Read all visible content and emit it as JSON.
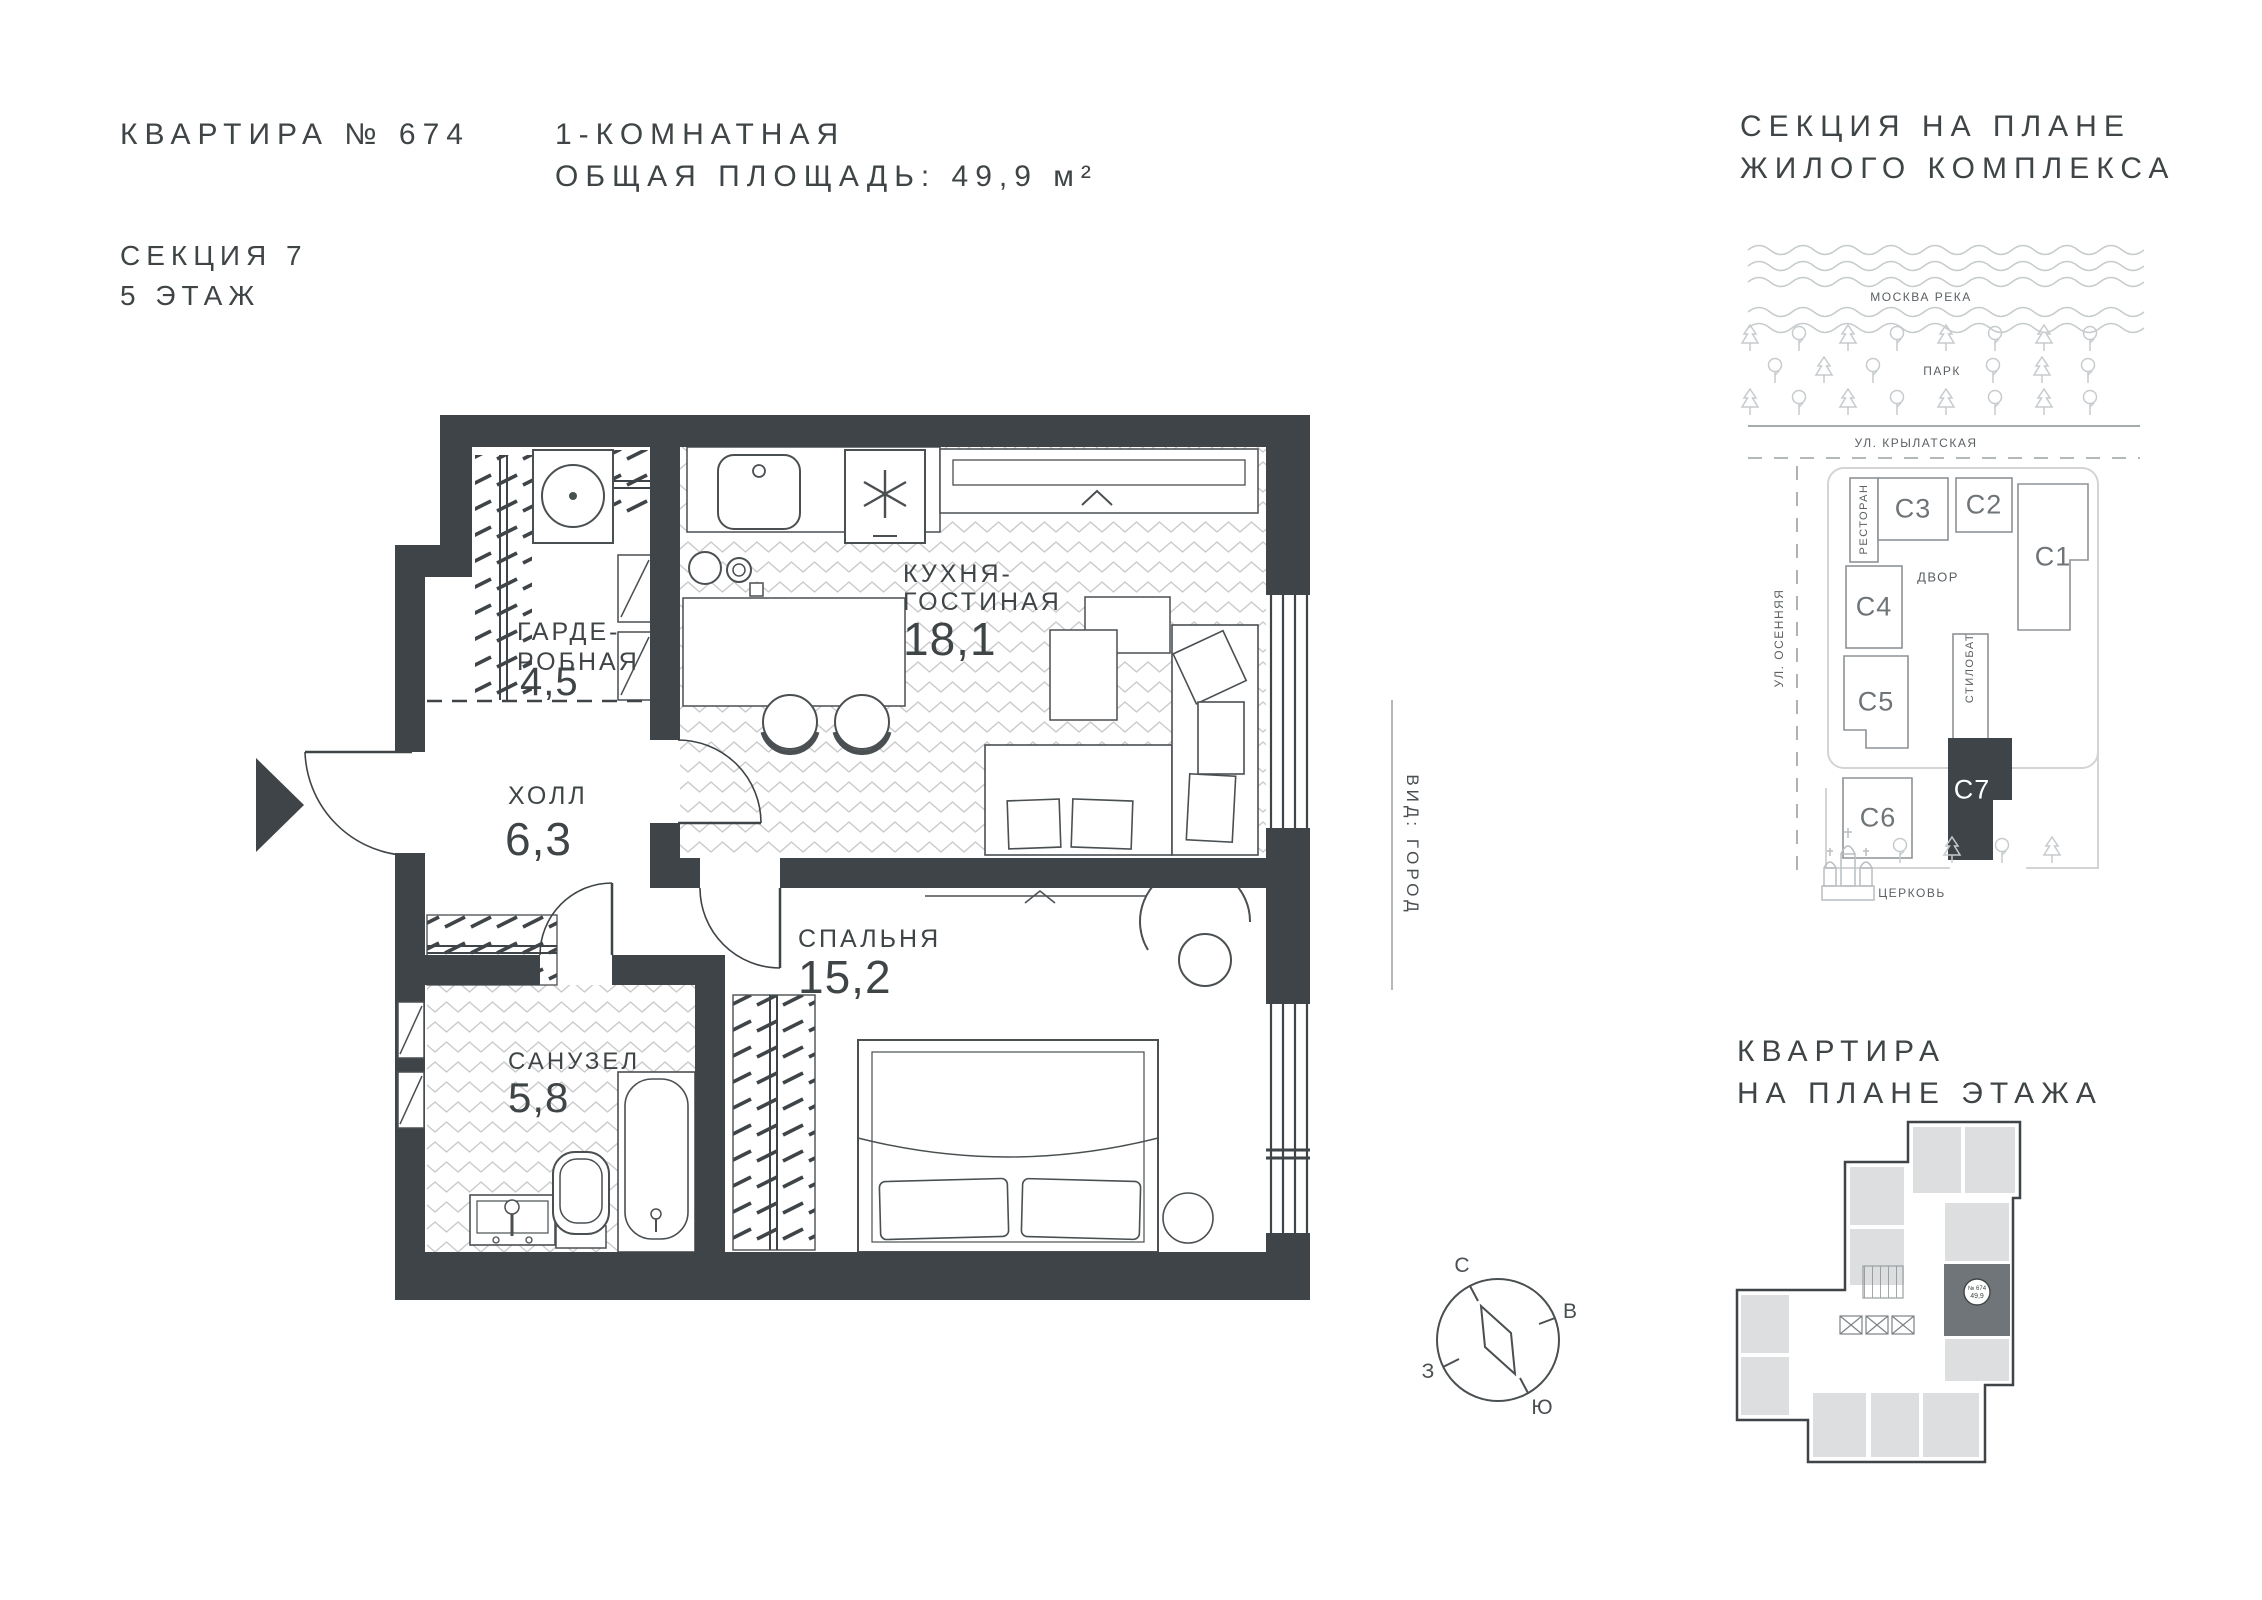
{
  "header": {
    "apartment_number": "КВАРТИРА № 674",
    "section": "СЕКЦИЯ 7",
    "floor": "5 ЭТАЖ",
    "type_line": "1-КОМНАТНАЯ",
    "area_line": "ОБЩАЯ ПЛОЩАДЬ: 49,9 м²"
  },
  "site_plan": {
    "title_line1": "СЕКЦИЯ НА ПЛАНЕ",
    "title_line2": "ЖИЛОГО КОМПЛЕКСА",
    "river_label": "МОСКВА РЕКА",
    "park_label": "ПАРК",
    "street_top": "УЛ. КРЫЛАТСКАЯ",
    "street_left": "УЛ. ОСЕННЯЯ",
    "restaurant_label": "РЕСТОРАН",
    "courtyard_label": "ДВОР",
    "stylobate_label": "СТИЛОБАТ",
    "church_label": "ЦЕРКОВЬ",
    "sections": [
      "С1",
      "С2",
      "С3",
      "С4",
      "С5",
      "С6",
      "С7"
    ]
  },
  "floor_plan": {
    "rooms": [
      {
        "line1": "ГАРДЕ-",
        "line2": "РОБНАЯ",
        "area": "4,5"
      },
      {
        "line1": "ХОЛЛ",
        "area": "6,3"
      },
      {
        "line1": "КУХНЯ-",
        "line2": "ГОСТИНАЯ",
        "area": "18,1"
      },
      {
        "line1": "САНУЗЕЛ",
        "area": "5,8"
      },
      {
        "line1": "СПАЛЬНЯ",
        "area": "15,2"
      }
    ],
    "view_label": "ВИД: ГОРОД"
  },
  "compass": {
    "north": "С",
    "east": "В",
    "west": "З",
    "south": "Ю"
  },
  "mini_plan": {
    "title_line1": "КВАРТИРА",
    "title_line2": "НА ПЛАНЕ ЭТАЖА",
    "badge_number": "№ 674",
    "badge_area": "49,9"
  }
}
